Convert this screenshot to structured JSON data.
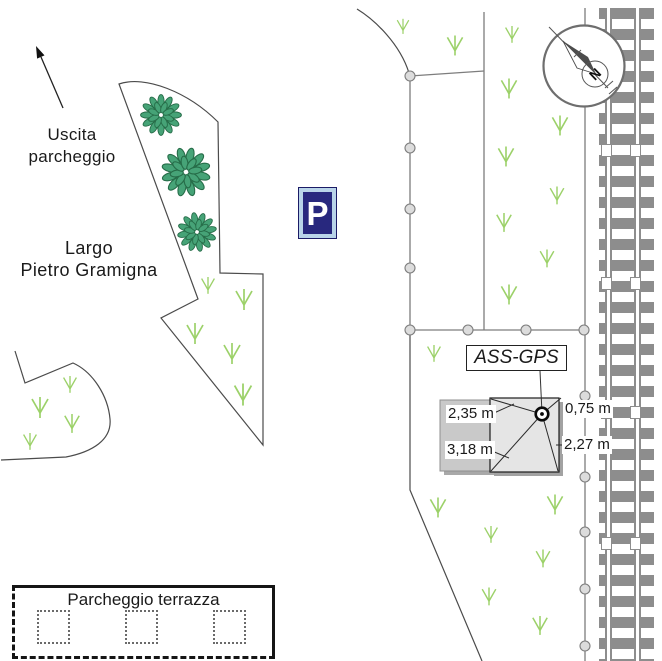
{
  "labels": {
    "exit_line1": "Uscita",
    "exit_line2": "parcheggio",
    "square_line1": "Largo",
    "square_line2": "Pietro Gramigna",
    "parking_sign": "P",
    "station": "ASS-GPS",
    "terrace_parking": "Parcheggio terrazza",
    "north": "N"
  },
  "measurements": {
    "nw_corner": "2,35 m",
    "sw_corner": "3,18 m",
    "ne_corner": "0,75 m",
    "se_corner": "2,27 m"
  },
  "icons": {
    "parking_sign": "blue-square-white-P",
    "compass": "north-needle-circle",
    "gps_marker": "circled-dot",
    "vegetation": "grass-tuft",
    "tree": "leaf-ring"
  },
  "colors": {
    "parking_sign_blue": "#28287e",
    "parking_sign_frame": "#b9d4e9",
    "grass_green": "#9cd169",
    "tree_fill": "#46a377",
    "tree_outline": "#266c48",
    "railway_gray": "#8d8d8d",
    "outline_gray": "#4b4b4b",
    "fence_gray": "#7d7d7d",
    "building_fill": "#e5e5e5",
    "annex_fill": "#c9c9c9"
  }
}
